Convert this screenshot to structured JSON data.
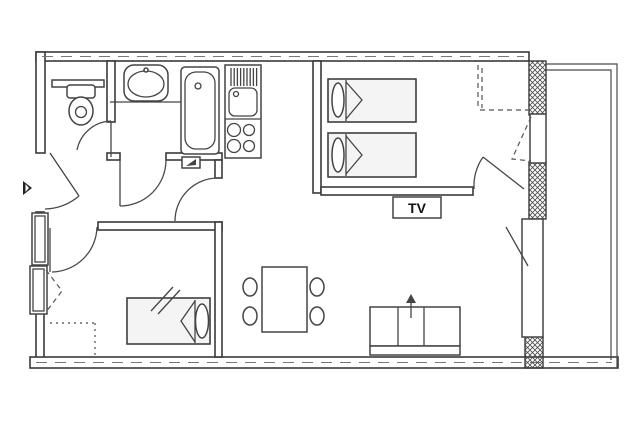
{
  "plan": {
    "tv_label": "TV"
  },
  "colors": {
    "background": "#ffffff",
    "line": "#3a3a3a",
    "fixture_line": "#444444",
    "hatch_wall": "#4a4a4a",
    "label_text": "#111111"
  },
  "fixtures": [
    {
      "name": "entry-arrow-icon"
    },
    {
      "name": "toilet-icon"
    },
    {
      "name": "washbasin-icon"
    },
    {
      "name": "bathtub-icon"
    },
    {
      "name": "kitchen-sink-icon"
    },
    {
      "name": "stove-burners-icon"
    },
    {
      "name": "twin-bed-icon"
    },
    {
      "name": "twin-bed-icon"
    },
    {
      "name": "single-bed-icon"
    },
    {
      "name": "tv-label-box"
    },
    {
      "name": "dining-table-icon"
    },
    {
      "name": "chair-icon"
    },
    {
      "name": "chair-icon"
    },
    {
      "name": "chair-icon"
    },
    {
      "name": "chair-icon"
    },
    {
      "name": "sofa-bed-icon"
    },
    {
      "name": "balcony-door-icon"
    },
    {
      "name": "window-icon"
    }
  ]
}
